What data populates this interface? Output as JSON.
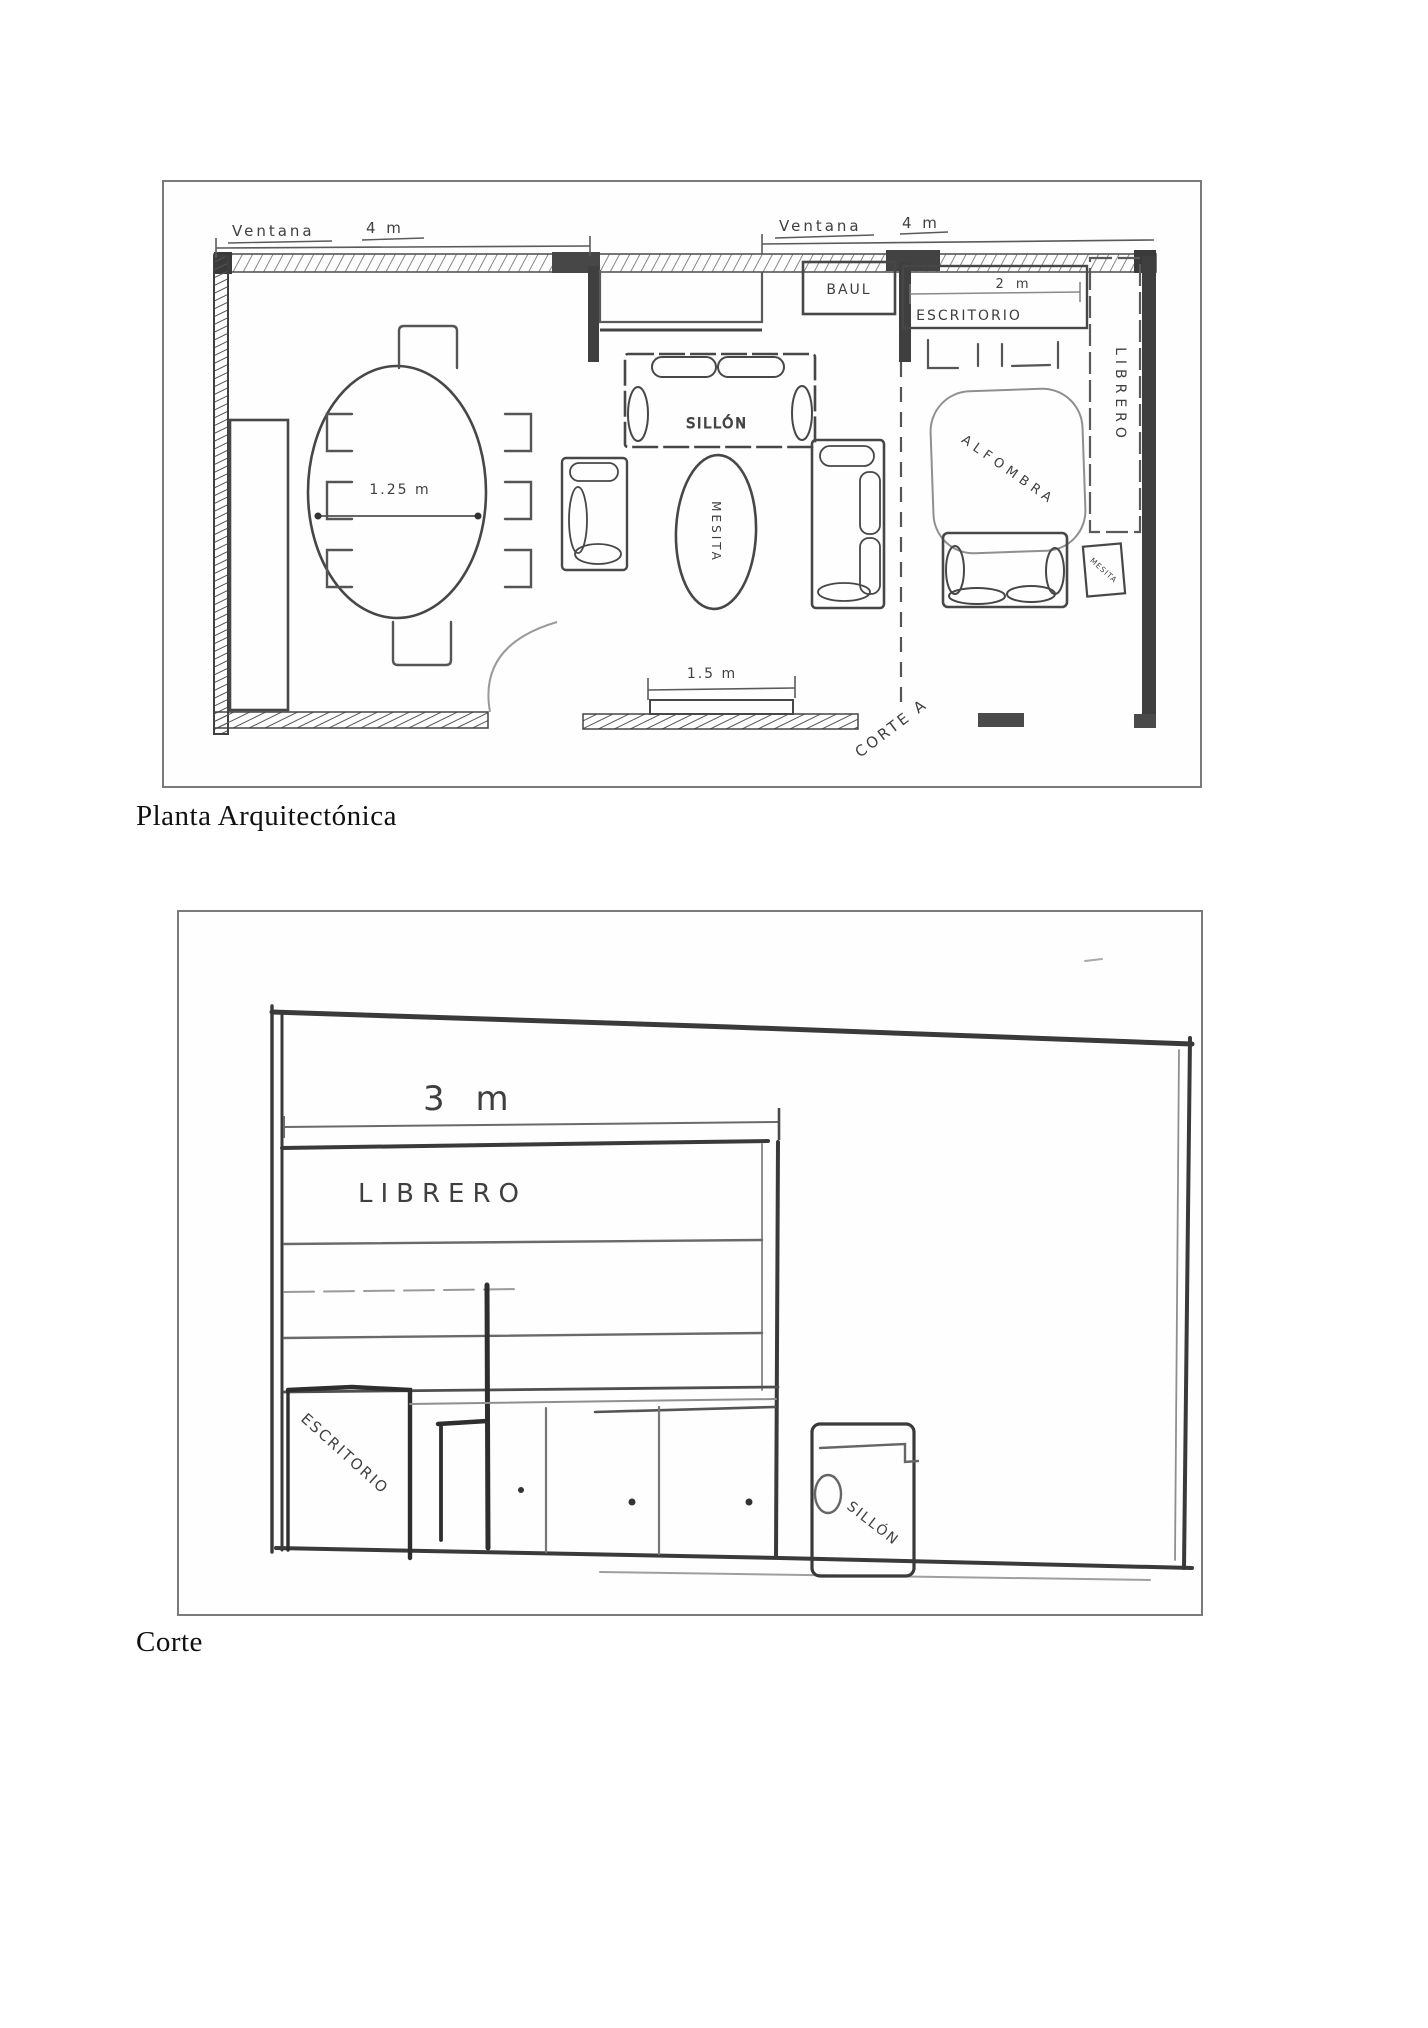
{
  "figure_plan": {
    "caption": "Planta Arquitectónica",
    "labels": {
      "ventana_left": "Ventana",
      "ventana_left_dim": "4 m",
      "ventana_right": "Ventana",
      "ventana_right_dim": "4 m",
      "baul": "BAUL",
      "escritorio": "ESCRITORIO",
      "escritorio_dim": "2 m",
      "librero": "LIBRERO",
      "alfombra": "ALFOMBRA",
      "sillon": "SILLÓN",
      "mesita": "MESITA",
      "side_table": "MESITA",
      "table_dim": "1.25 m",
      "window_dim": "1.5 m",
      "section_line": "CORTE A"
    }
  },
  "figure_section": {
    "caption": "Corte",
    "labels": {
      "dim_3m": "3 m",
      "librero": "LIBRERO",
      "escritorio": "ESCRITORIO",
      "sillon": "SILLÓN"
    }
  },
  "colors": {
    "pencil_dark": "#2e2e2e",
    "pencil": "#4a4a4a",
    "pencil_light": "#8f8f8f",
    "frame_border": "#7a7a7a",
    "paper": "#ffffff"
  }
}
